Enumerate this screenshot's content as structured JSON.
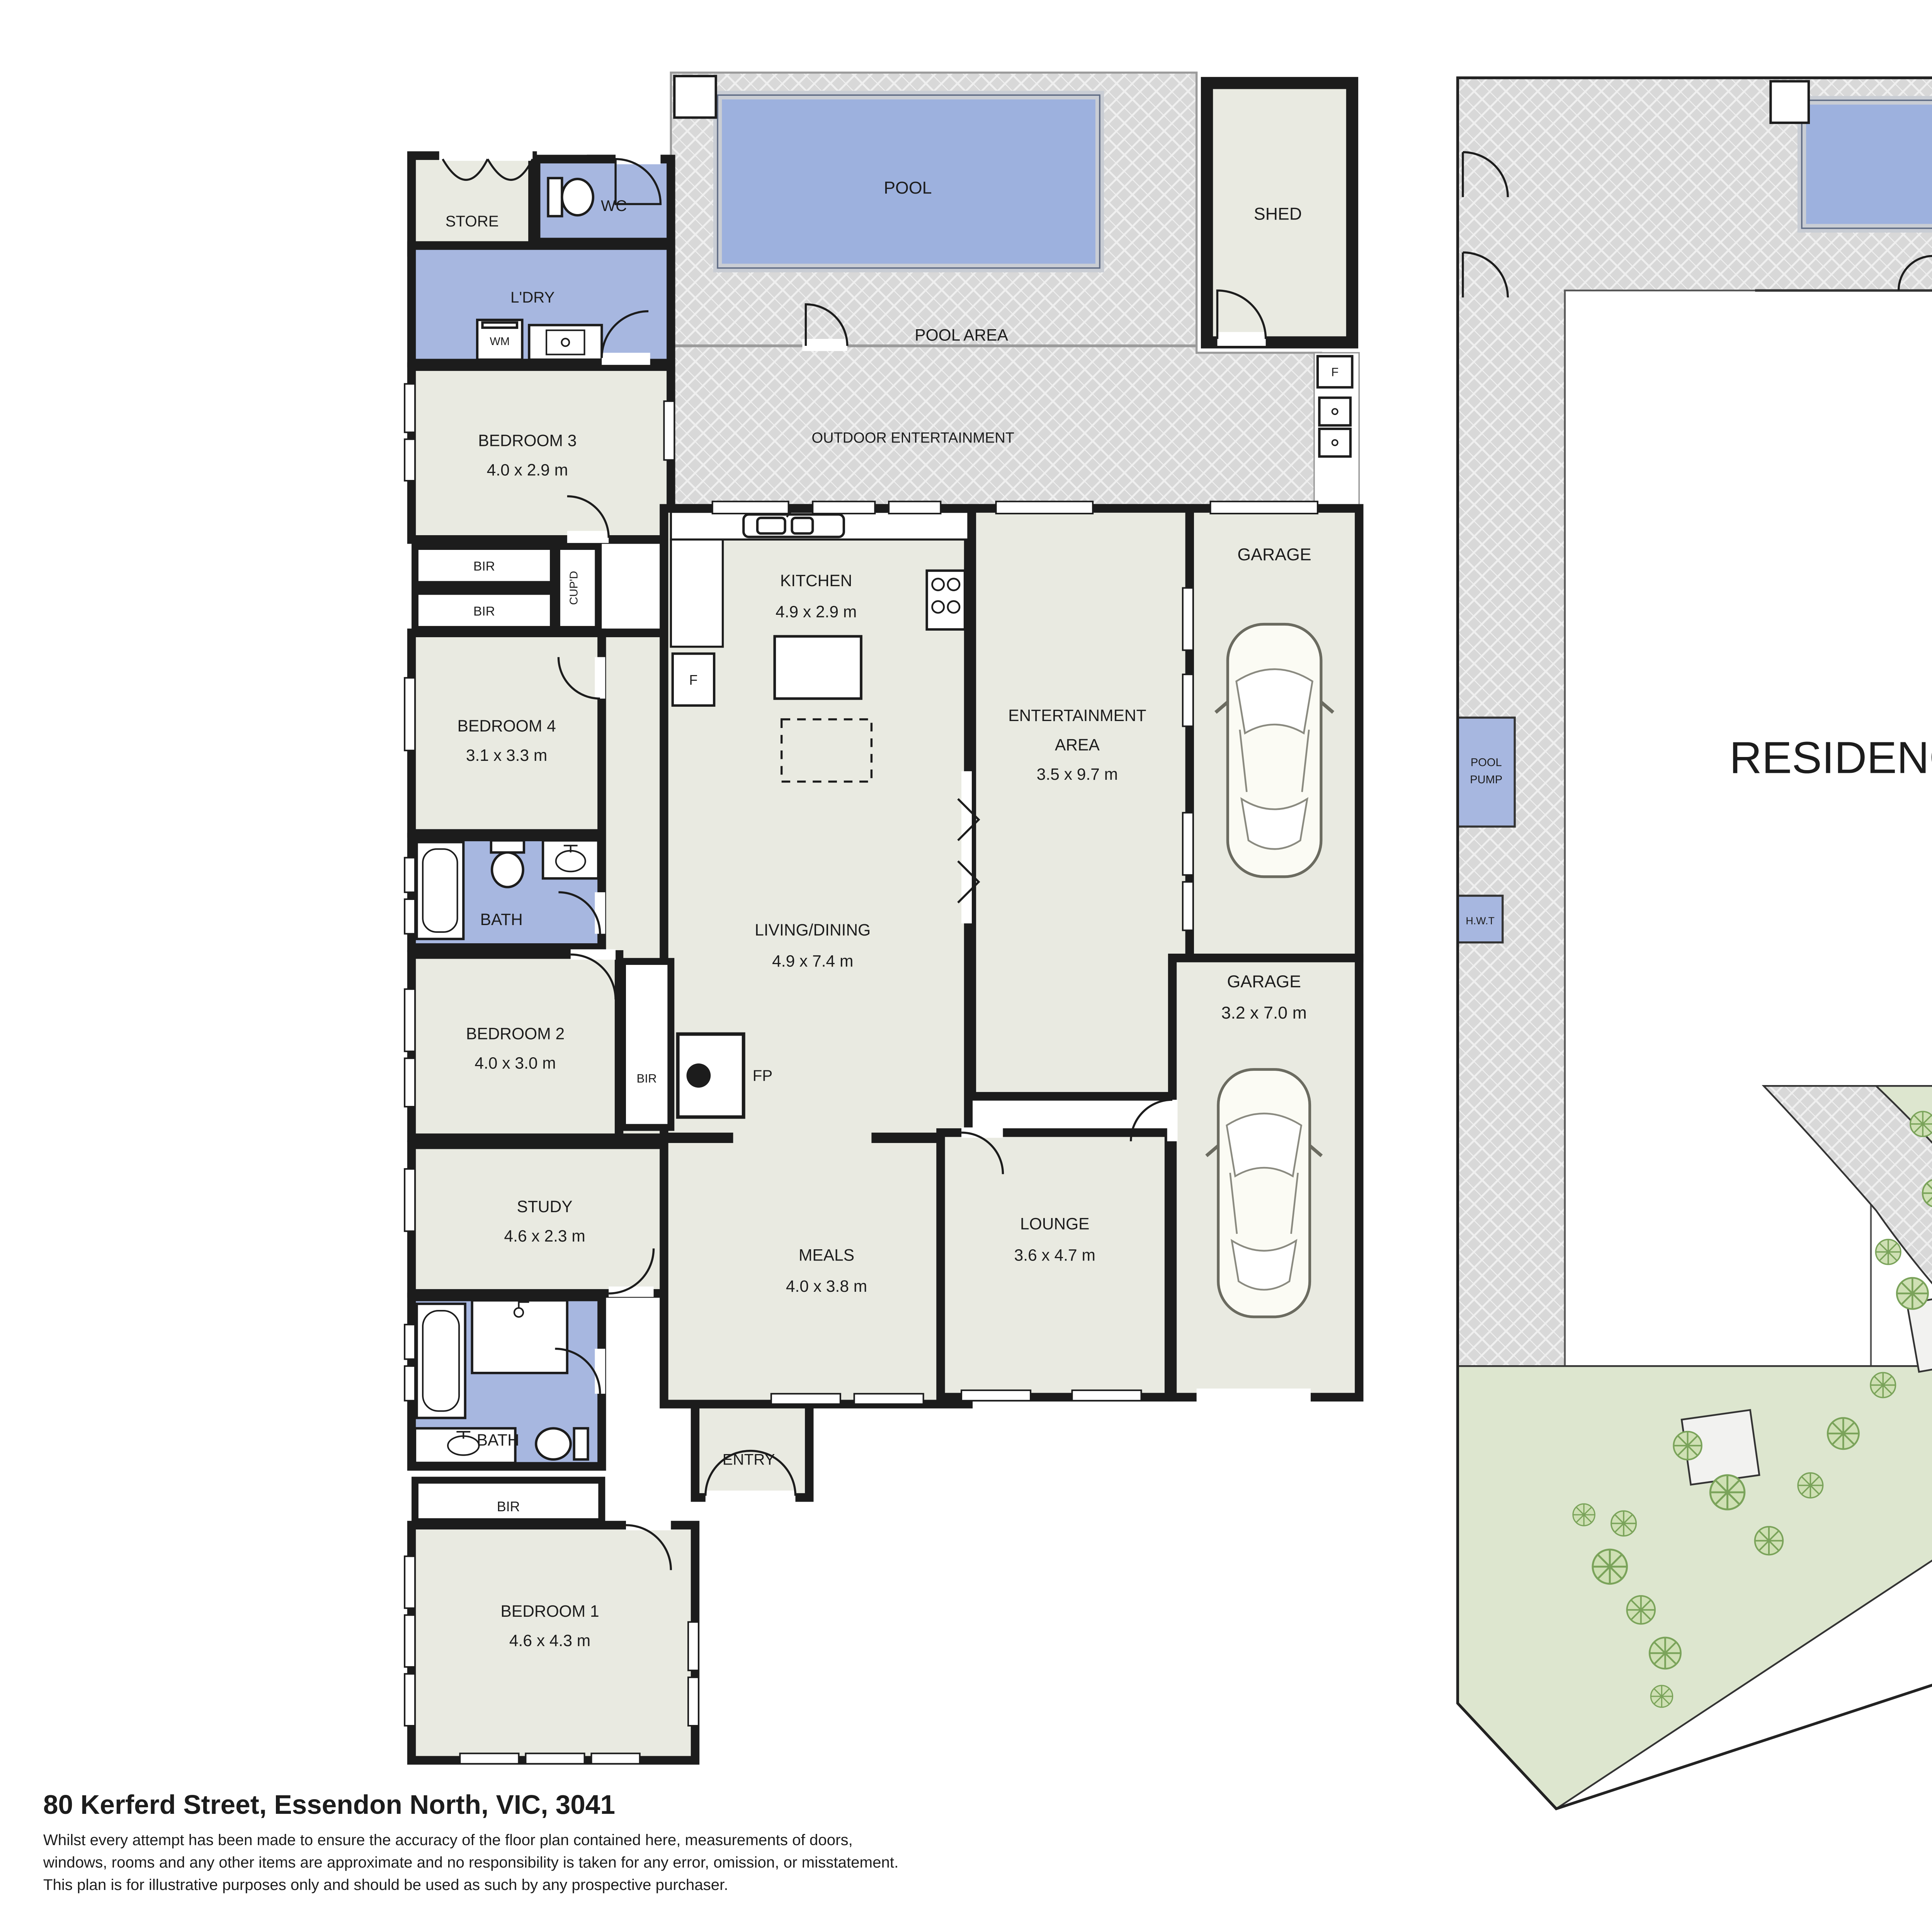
{
  "meta": {
    "address": "80 Kerferd Street, Essendon North, VIC, 3041",
    "disclaimer_lines": [
      "Whilst every attempt has been made to ensure the accuracy of the floor plan contained here, measurements of doors,",
      "windows, rooms and any other items are approximate and no responsibility is taken for any error, omission, or misstatement.",
      "This plan is for illustrative purposes only and should be used as such by any prospective purchaser."
    ]
  },
  "compass": {
    "north_label": "N"
  },
  "colors": {
    "room_beige": "#e9eae1",
    "wet_blue": "#a7b7e0",
    "pool_blue": "#9db1de",
    "paving_gray": "#d8d8d8",
    "garden_green": "#dde6cf",
    "tree_green": "#7aa35a",
    "wall_black": "#1c1c1c"
  },
  "floor_plan": {
    "outdoor": {
      "pool": "POOL",
      "pool_area": "POOL AREA",
      "outdoor_entertainment": "OUTDOOR ENTERTAINMENT",
      "shed": "SHED",
      "fridge": "F"
    },
    "rooms": {
      "store": {
        "name": "STORE"
      },
      "wc": {
        "name": "WC"
      },
      "laundry": {
        "name": "L'DRY"
      },
      "wm": {
        "name": "WM"
      },
      "bedroom3": {
        "name": "BEDROOM 3",
        "dims": "4.0 x 2.9 m"
      },
      "bir1": {
        "name": "BIR"
      },
      "bir2": {
        "name": "BIR"
      },
      "cupd": {
        "name": "CUP'D"
      },
      "bedroom4": {
        "name": "BEDROOM 4",
        "dims": "3.1 x 3.3 m"
      },
      "bath1": {
        "name": "BATH"
      },
      "bedroom2": {
        "name": "BEDROOM 2",
        "dims": "4.0 x 3.0 m"
      },
      "bir3": {
        "name": "BIR"
      },
      "fp": {
        "name": "FP"
      },
      "study": {
        "name": "STUDY",
        "dims": "4.6 x 2.3 m"
      },
      "bath2": {
        "name": "BATH"
      },
      "bir4": {
        "name": "BIR"
      },
      "bedroom1": {
        "name": "BEDROOM 1",
        "dims": "4.6 x 4.3 m"
      },
      "entry": {
        "name": "ENTRY"
      },
      "kitchen": {
        "name": "KITCHEN",
        "dims": "4.9 x 2.9 m"
      },
      "fridge": {
        "name": "F"
      },
      "living": {
        "name": "LIVING/DINING",
        "dims": "4.9 x 7.4 m"
      },
      "meals": {
        "name": "MEALS",
        "dims": "4.0 x 3.8 m"
      },
      "lounge": {
        "name": "LOUNGE",
        "dims": "3.6 x 4.7 m"
      },
      "entertainment": {
        "name": "ENTERTAINMENT",
        "word2": "AREA",
        "dims": "3.5 x 9.7 m"
      },
      "garage1": {
        "name": "GARAGE"
      },
      "garage2": {
        "name": "GARAGE",
        "dims": "3.2 x 7.0 m"
      }
    }
  },
  "site_plan": {
    "residence": "RESIDENCE",
    "pool": "POOL",
    "pool_area": "POOL AREA",
    "shed": "SHED",
    "garage_upper": "GARAGE",
    "garage_lower": "GARAGE",
    "driveway": "DRIVEWAY",
    "pool_pump_line1": "POOL",
    "pool_pump_line2": "PUMP",
    "hwt": "H.W.T",
    "fridge": "F"
  }
}
